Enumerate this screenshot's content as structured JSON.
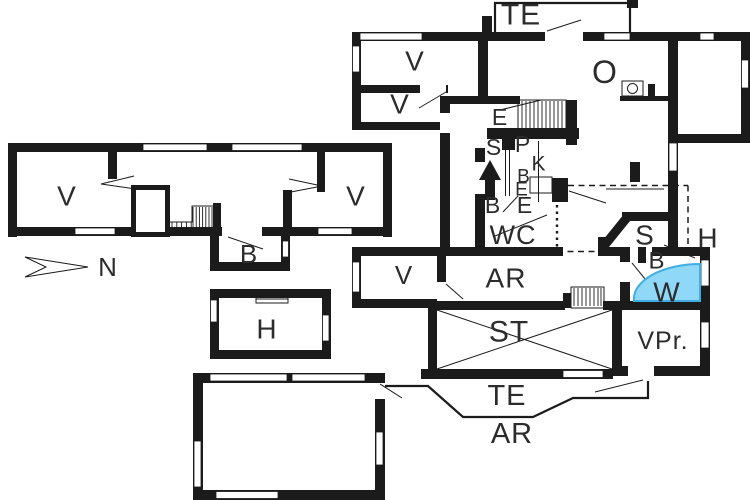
{
  "colors": {
    "wall": "#1b1b1b",
    "text": "#2c2c2c",
    "highlight_fill": "#8FD8F7",
    "highlight_stroke": "#41AEE2",
    "background": "#ffffff"
  },
  "compass": {
    "label": "N"
  },
  "labels": {
    "te_top": "TE",
    "v_upper1": "V",
    "v_upper2": "V",
    "o_room": "O",
    "e_hall": "E",
    "s_sp": "S",
    "p_sp": "P",
    "k_room": "K",
    "b_k": "B",
    "e_k": "E",
    "b_we": "B",
    "e_we": "E",
    "wc": "WC",
    "v_left": "V",
    "v_right": "V",
    "b_annex": "B",
    "h_room": "H",
    "v_low": "V",
    "ar_room": "AR",
    "st_room": "ST",
    "s_room": "S",
    "h_right": "H",
    "b_right": "B",
    "w_room": "W",
    "vpr_room": "VPr.",
    "te_bottom": "TE",
    "ar_bottom": "AR"
  }
}
